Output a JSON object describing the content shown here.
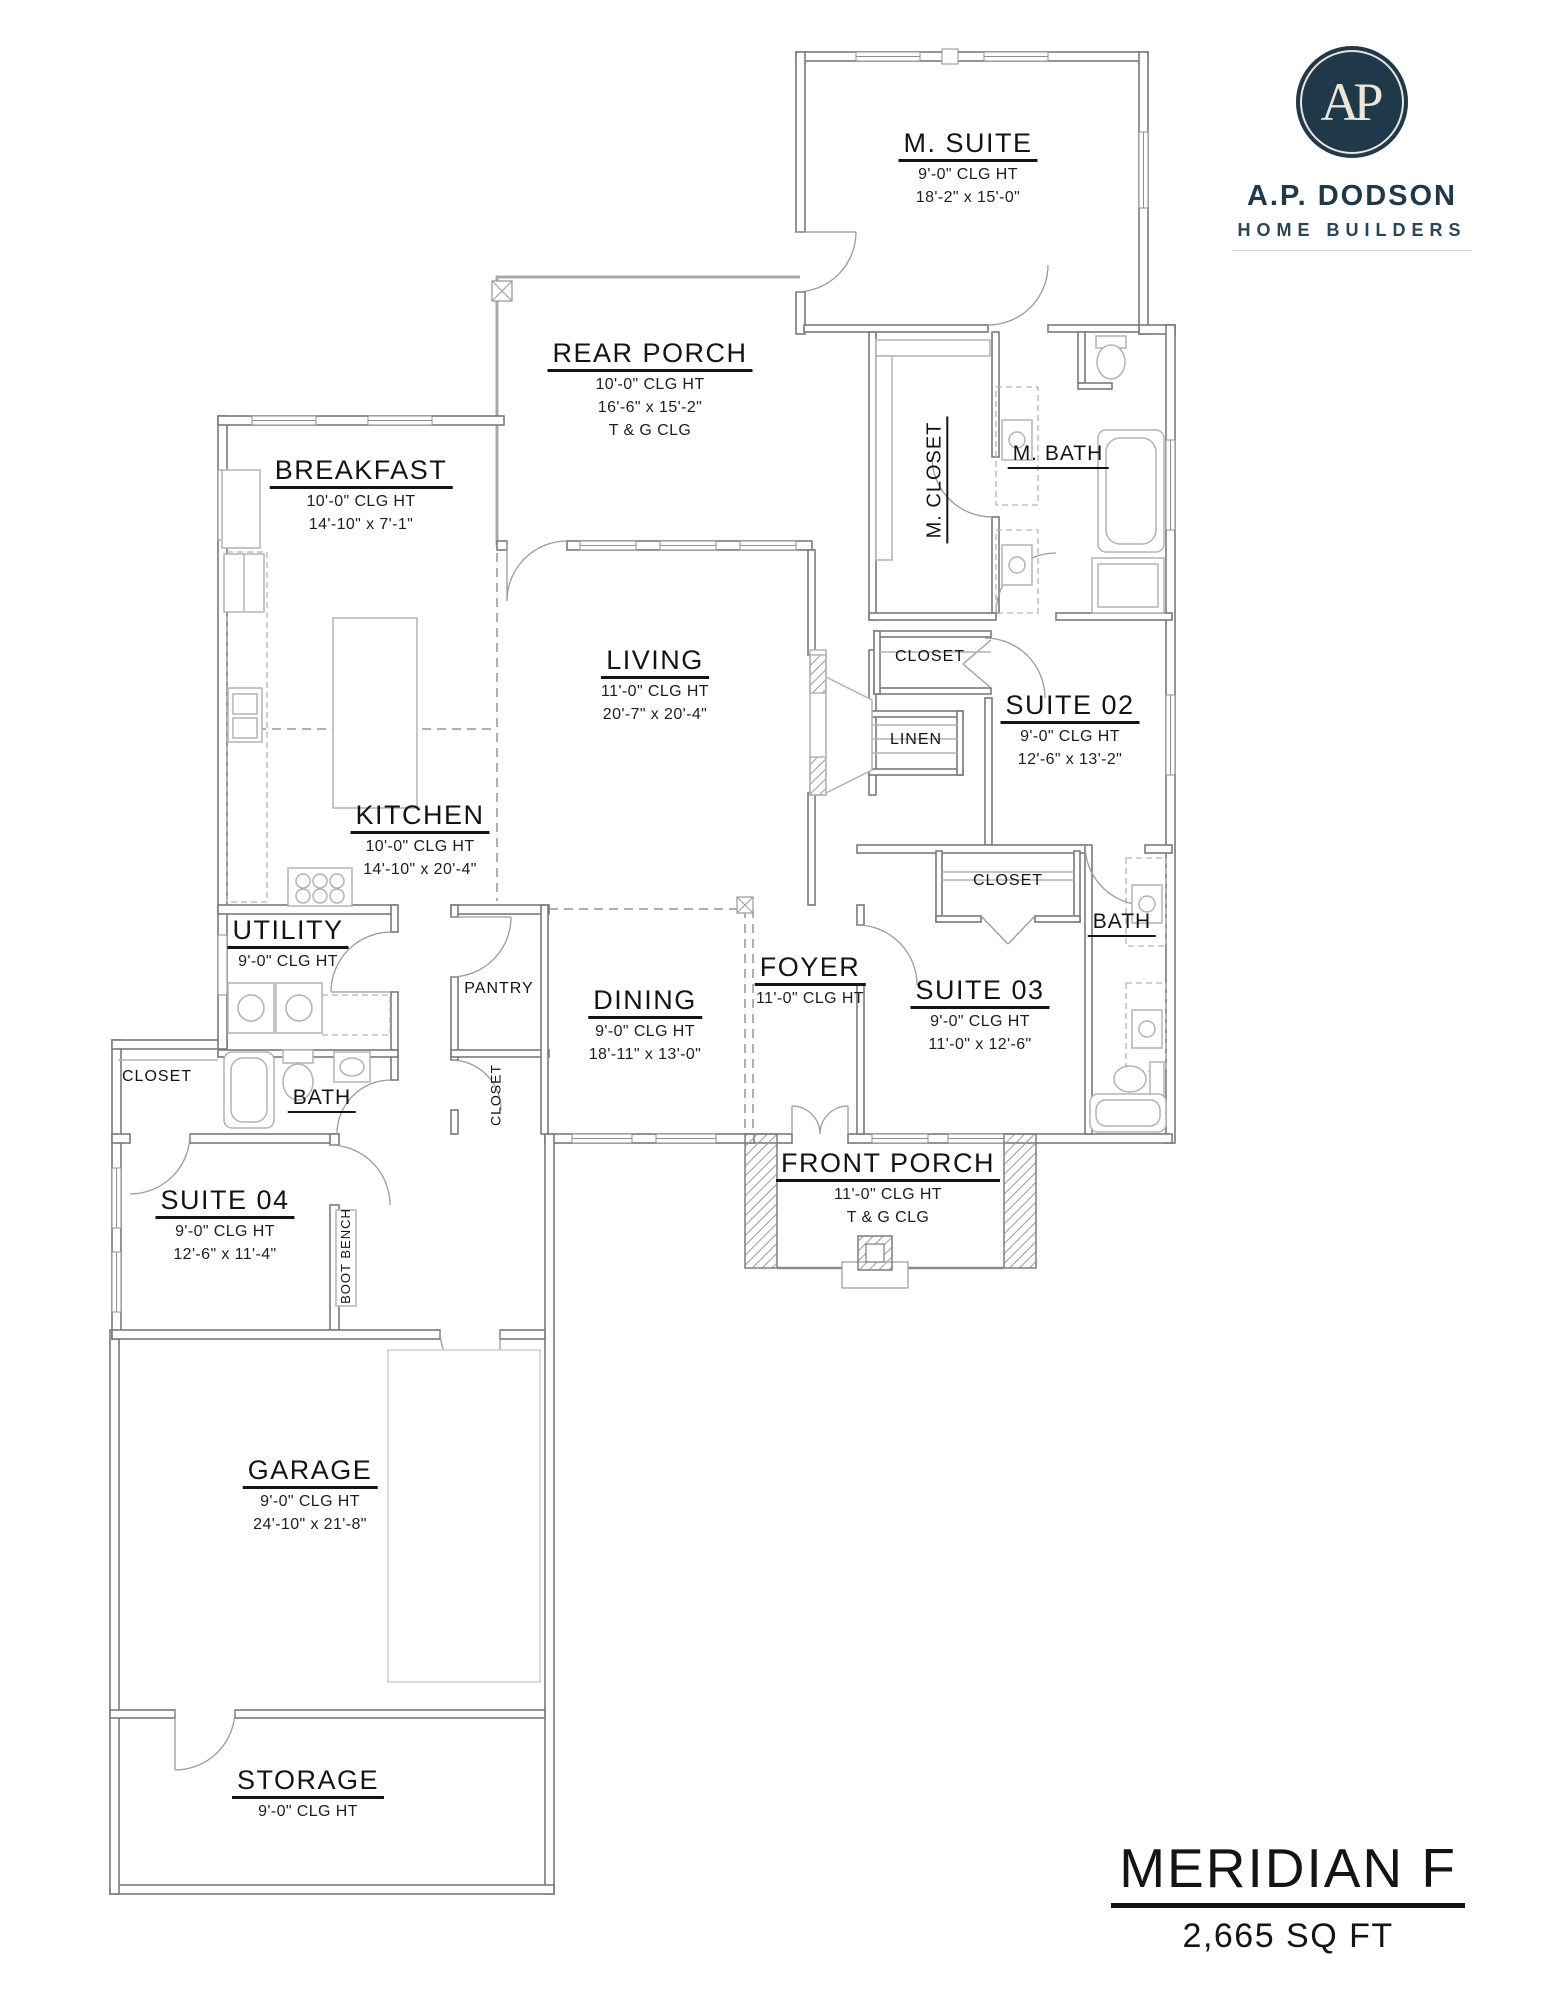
{
  "branding": {
    "monogram": "AP",
    "name": "A.P. DODSON",
    "tagline": "HOME BUILDERS",
    "brand_color": "#20394a"
  },
  "title_block": {
    "plan_name": "MERIDIAN F",
    "area": "2,665 SQ FT"
  },
  "rooms": {
    "m_suite": {
      "title": "M. SUITE",
      "line1": "9'-0\" CLG HT",
      "line2": "18'-2\" x 15'-0\""
    },
    "rear_porch": {
      "title": "REAR PORCH",
      "line1": "10'-0\" CLG HT",
      "line2": "16'-6\" x 15'-2\"",
      "line3": "T & G CLG"
    },
    "breakfast": {
      "title": "BREAKFAST",
      "line1": "10'-0\" CLG HT",
      "line2": "14'-10\" x 7'-1\""
    },
    "m_closet": {
      "title": "M. CLOSET"
    },
    "m_bath": {
      "title": "M. BATH"
    },
    "living": {
      "title": "LIVING",
      "line1": "11'-0\" CLG HT",
      "line2": "20'-7\" x 20'-4\""
    },
    "suite02": {
      "title": "SUITE 02",
      "line1": "9'-0\" CLG HT",
      "line2": "12'-6\" x 13'-2\""
    },
    "closet_suite02": {
      "title": "CLOSET"
    },
    "linen": {
      "title": "LINEN"
    },
    "kitchen": {
      "title": "KITCHEN",
      "line1": "10'-0\" CLG HT",
      "line2": "14'-10\" x 20'-4\""
    },
    "closet_suite03": {
      "title": "CLOSET"
    },
    "bath_suites": {
      "title": "BATH"
    },
    "utility": {
      "title": "UTILITY",
      "line1": "9'-0\" CLG HT"
    },
    "pantry": {
      "title": "PANTRY"
    },
    "dining": {
      "title": "DINING",
      "line1": "9'-0\" CLG HT",
      "line2": "18'-11\" x 13'-0\""
    },
    "foyer": {
      "title": "FOYER",
      "line1": "11'-0\" CLG HT"
    },
    "suite03": {
      "title": "SUITE 03",
      "line1": "9'-0\" CLG HT",
      "line2": "11'-0\" x 12'-6\""
    },
    "closet_suite04": {
      "title": "CLOSET"
    },
    "bath_suite04": {
      "title": "BATH"
    },
    "closet_hall": {
      "title": "CLOSET"
    },
    "suite04": {
      "title": "SUITE 04",
      "line1": "9'-0\" CLG HT",
      "line2": "12'-6\" x 11'-4\""
    },
    "boot_bench": {
      "title": "BOOT BENCH"
    },
    "front_porch": {
      "title": "FRONT PORCH",
      "line1": "11'-0\" CLG HT",
      "line2": "T & G CLG"
    },
    "garage": {
      "title": "GARAGE",
      "line1": "9'-0\" CLG HT",
      "line2": "24'-10\" x 21'-8\""
    },
    "storage": {
      "title": "STORAGE",
      "line1": "9'-0\" CLG HT"
    }
  }
}
